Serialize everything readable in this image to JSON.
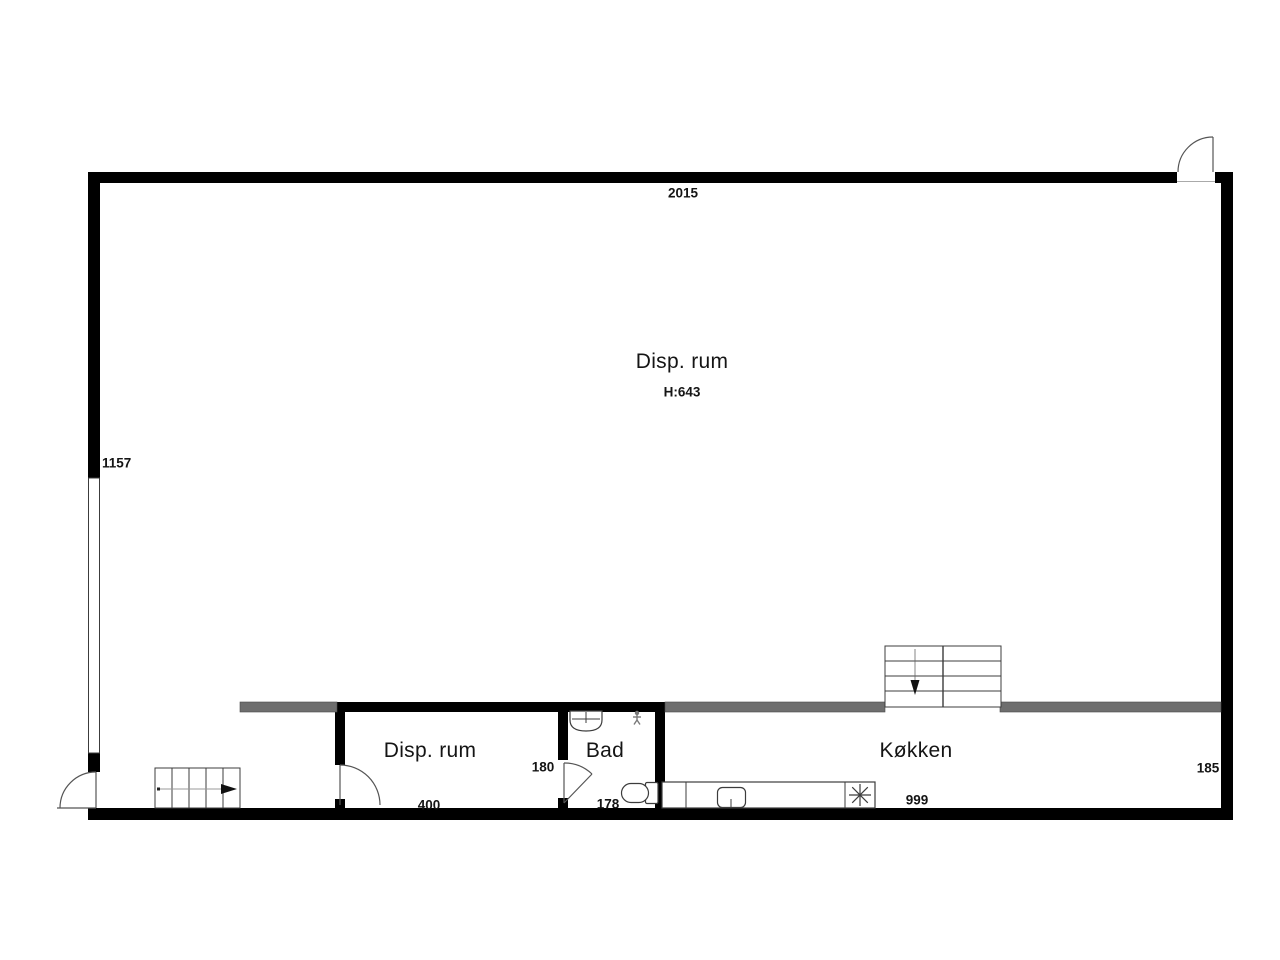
{
  "plan": {
    "main_room": {
      "label": "Disp. rum",
      "height_note": "H:643"
    },
    "bottom_rooms": [
      {
        "label": "Disp. rum",
        "width_dim": "400"
      },
      {
        "label": "Bad",
        "door_dim": "180",
        "width_dim": "178"
      },
      {
        "label": "Køkken",
        "width_dim": "999"
      }
    ],
    "dimensions": {
      "top_width": "2015",
      "left_height": "1157",
      "right_height": "185"
    },
    "icons": {
      "bath_sink": "sink-icon",
      "shower_person": "person-icon",
      "toilet": "toilet-icon",
      "kitchen_sink": "sink-icon",
      "stove": "stove-burner-icon",
      "stairs_entry_arrow": "arrow-right-icon",
      "stairs_kitchen_arrow": "arrow-down-icon"
    },
    "colors": {
      "wall": "#000000",
      "partition_rail": "#6e6e6e",
      "outline": "#3c3c3c",
      "door_line": "#555555",
      "arrow_line": "#999999",
      "background": "#ffffff",
      "text": "#151515"
    }
  }
}
